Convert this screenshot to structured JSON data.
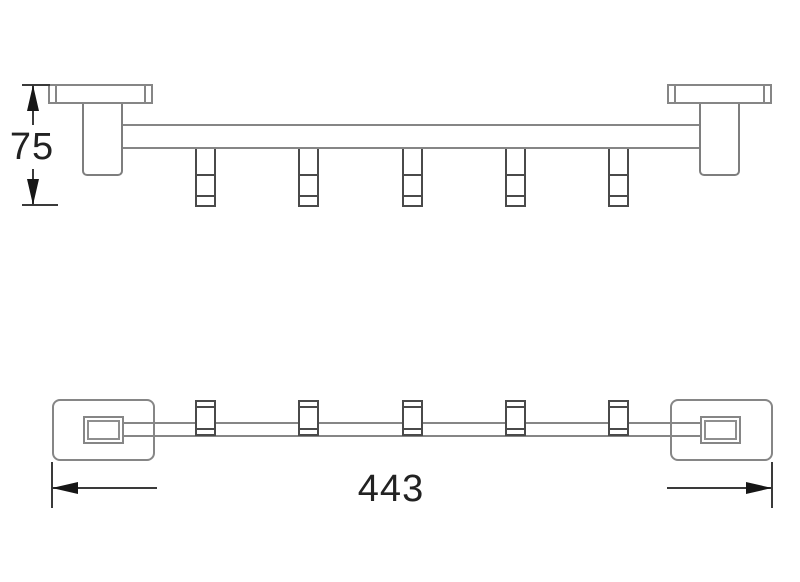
{
  "drawing": {
    "background": "#ffffff",
    "colors": {
      "outline": "#868686",
      "hook_outline": "#4a4a4a",
      "dimension_line": "#3a3a3a",
      "dimension_text": "#222222",
      "arrow": "#161616"
    },
    "views": {
      "side_view": {
        "id": "side-elevation",
        "hook_count": 5,
        "bracket_count": 2
      },
      "plan_view": {
        "id": "plan-view",
        "hook_count": 5,
        "bracket_count": 2
      }
    },
    "dimensions": {
      "height": {
        "value": "75",
        "orientation": "vertical"
      },
      "length": {
        "value": "443",
        "orientation": "horizontal"
      }
    }
  }
}
